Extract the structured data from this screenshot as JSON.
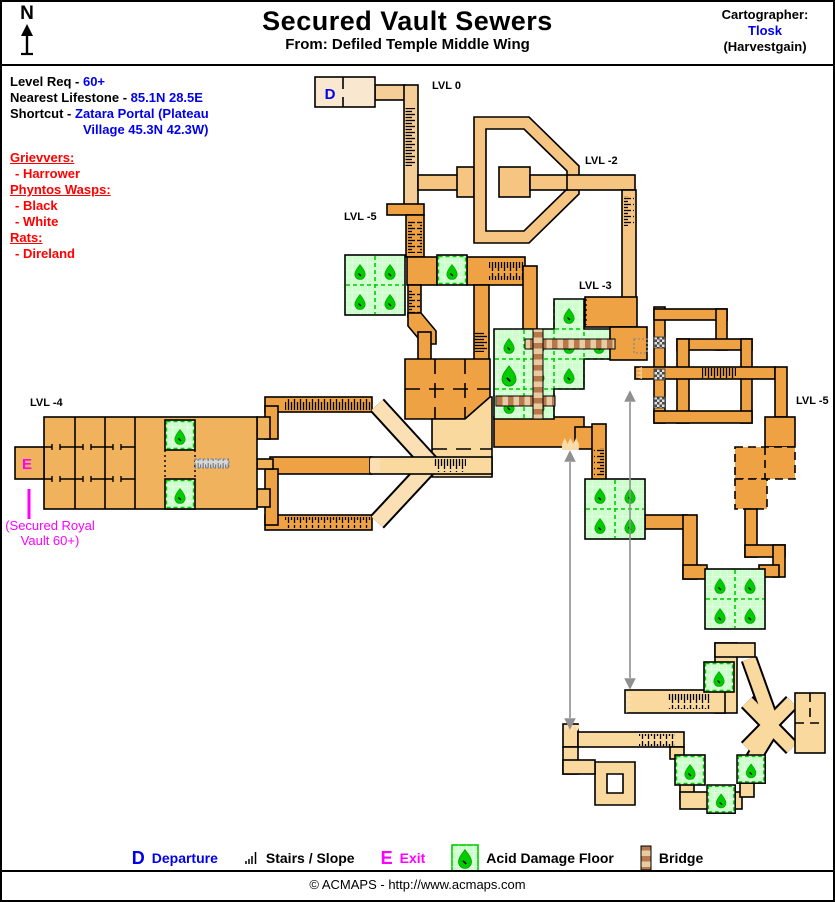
{
  "header": {
    "compass_label": "N",
    "title": "Secured Vault Sewers",
    "subtitle": "From: Defiled Temple Middle Wing",
    "cartographer_label": "Cartographer:",
    "cartographer_name": "Tlosk",
    "cartographer_server": "(Harvestgain)"
  },
  "info": {
    "level_req_label": "Level Req - ",
    "level_req_value": "60+",
    "lifestone_label": "Nearest Lifestone - ",
    "lifestone_value": "85.1N 28.5E",
    "shortcut_label": "Shortcut - ",
    "shortcut_value_line1": "Zatara Portal (Plateau",
    "shortcut_value_line2": "Village 45.3N 42.3W)"
  },
  "creatures": [
    {
      "group": "Grievvers:",
      "members": [
        "- Harrower"
      ]
    },
    {
      "group": "Phyntos Wasps:",
      "members": [
        "- Black",
        "- White"
      ]
    },
    {
      "group": "Rats:",
      "members": [
        "- Direland"
      ]
    }
  ],
  "map": {
    "labels": [
      "LVL 0",
      "LVL -2",
      "LVL -5",
      "LVL -3",
      "LVL -4",
      "LVL -5"
    ],
    "departure_marker": "D",
    "exit_marker": "E",
    "exit_note": [
      "(Secured Royal",
      "Vault 60+)"
    ]
  },
  "legend": {
    "departure_symbol": "D",
    "departure_label": "Departure",
    "stairs_label": "Stairs / Slope",
    "exit_symbol": "E",
    "exit_label": "Exit",
    "acid_label": "Acid Damage Floor",
    "bridge_label": "Bridge"
  },
  "footer": {
    "copyright": "© ACMAPS - http://www.acmaps.com"
  },
  "colors": {
    "corridor_dark": "#EEA243",
    "corridor_mid": "#F6C581",
    "corridor_lvl0": "#F5CD96",
    "room_lightest": "#FAE7CF",
    "room_lvl4": "#F0B25C",
    "corridor_light": "#FAD99E",
    "acid_bg": "#CCFFCC",
    "acid_green": "#00CC00",
    "bridge_brown": "#B5794C",
    "bridge_tan": "#E9CBA3",
    "marker_blue": "#0000EE",
    "marker_magenta": "#FF00FF",
    "creature_red": "#FF0000",
    "connector_gray": "#909090"
  }
}
